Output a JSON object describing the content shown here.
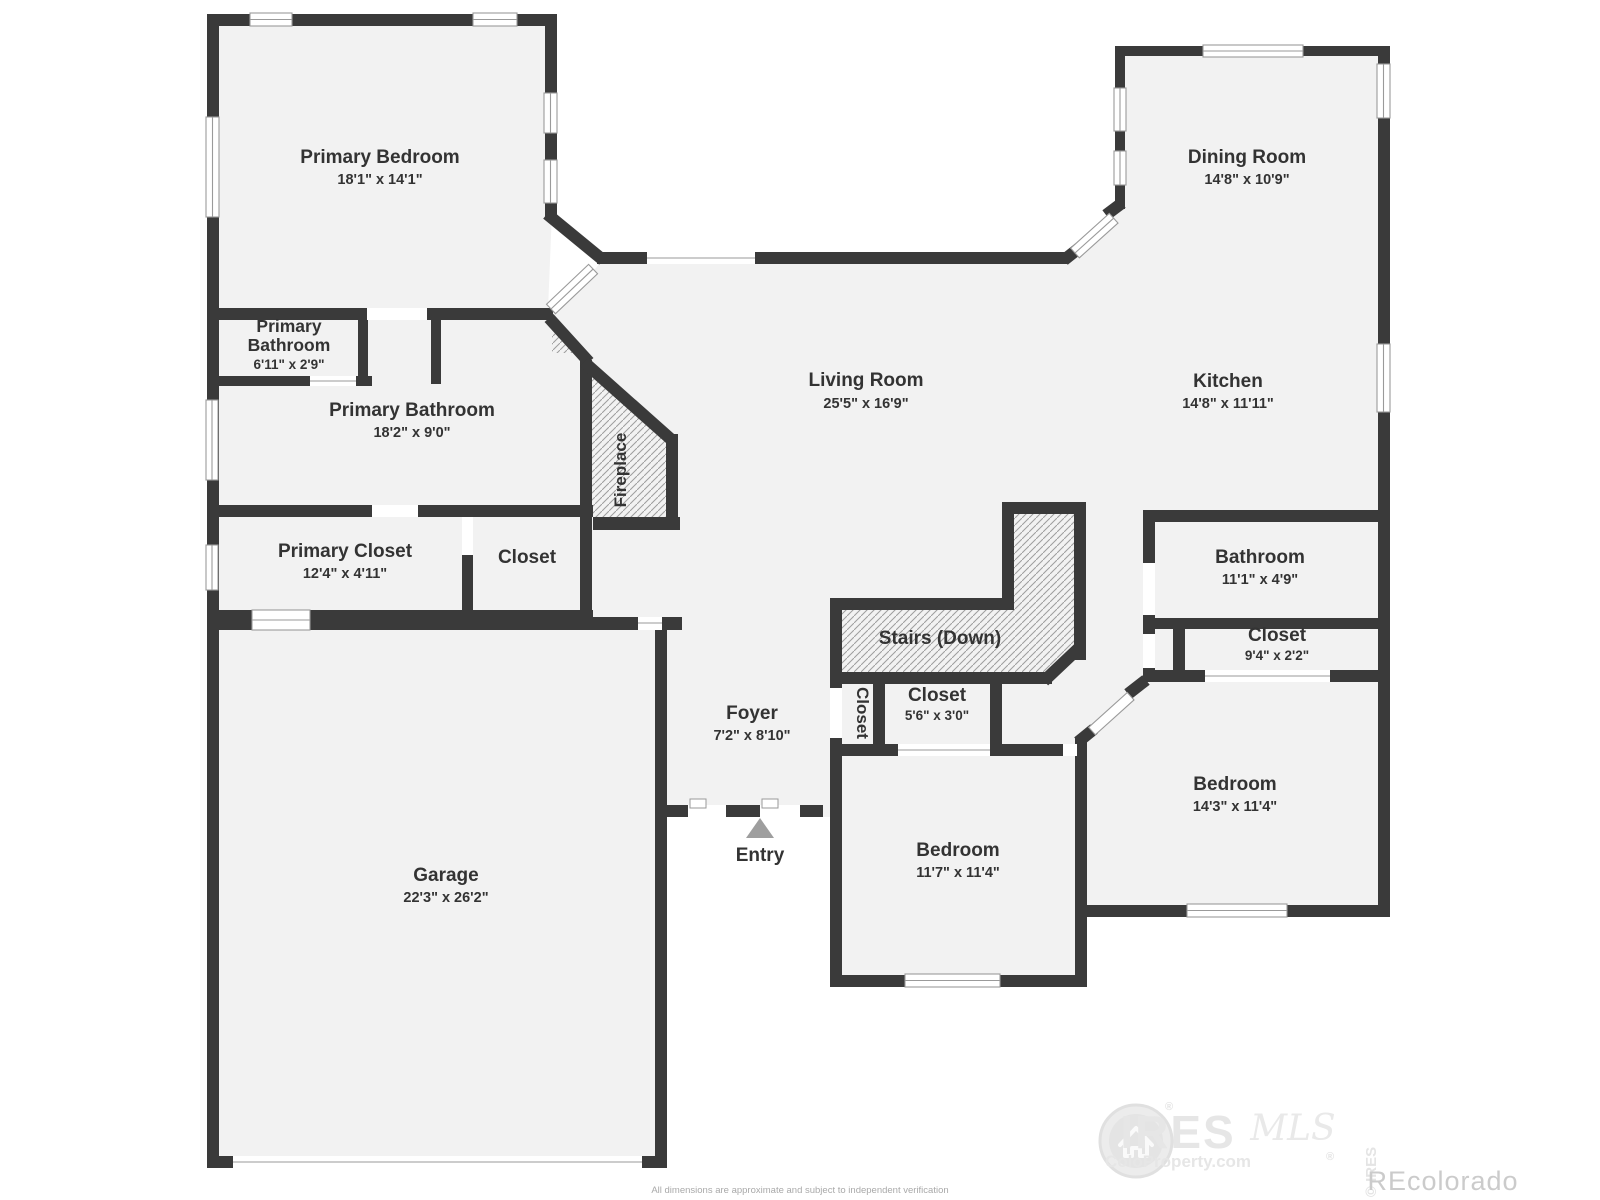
{
  "page": {
    "background": "#ffffff"
  },
  "plan": {
    "rooms": {
      "primary_bedroom": {
        "name": "Primary Bedroom",
        "dims": "18'1\" x 14'1\""
      },
      "dining_room": {
        "name": "Dining Room",
        "dims": "14'8\" x 10'9\""
      },
      "primary_bathroom_small": {
        "name_line1": "Primary",
        "name_line2": "Bathroom",
        "dims": "6'11\" x 2'9\""
      },
      "primary_bathroom": {
        "name": "Primary Bathroom",
        "dims": "18'2\" x 9'0\""
      },
      "living_room": {
        "name": "Living Room",
        "dims": "25'5\" x 16'9\""
      },
      "kitchen": {
        "name": "Kitchen",
        "dims": "14'8\" x 11'11\""
      },
      "primary_closet": {
        "name": "Primary Closet",
        "dims": "12'4\" x 4'11\""
      },
      "hall_closet": {
        "name": "Closet"
      },
      "fireplace": {
        "name": "Fireplace"
      },
      "stairs": {
        "name": "Stairs (Down)"
      },
      "foyer_closet": {
        "name": "Closet"
      },
      "bedroom_closet": {
        "name": "Closet",
        "dims": "5'6\" x 3'0\""
      },
      "bathroom": {
        "name": "Bathroom",
        "dims": "11'1\" x 4'9\""
      },
      "linen_closet": {
        "name": "Closet",
        "dims": "9'4\" x 2'2\""
      },
      "foyer": {
        "name": "Foyer",
        "dims": "7'2\" x 8'10\""
      },
      "entry": {
        "name": "Entry"
      },
      "bedroom_center": {
        "name": "Bedroom",
        "dims": "11'7\" x 11'4\""
      },
      "bedroom_right": {
        "name": "Bedroom",
        "dims": "14'3\" x 11'4\""
      },
      "garage": {
        "name": "Garage",
        "dims": "22'3\" x 26'2\""
      }
    },
    "disclaimer": "All dimensions are approximate and subject to independent verification",
    "watermark": {
      "brand": "IRES",
      "script": "MLS",
      "tagline": "ColoProperty.com",
      "registered": "®",
      "copyright": "© IRES",
      "partner": "REcolorado"
    },
    "colors": {
      "wall": "#3a3a3a",
      "floor": "#f2f2f2",
      "hatch_line": "#9d9d9d",
      "label_text": "#333333",
      "entry_arrow": "#9e9e9e",
      "watermark_light": "#e7e7e7",
      "watermark_gray": "#cbcbcb"
    }
  }
}
